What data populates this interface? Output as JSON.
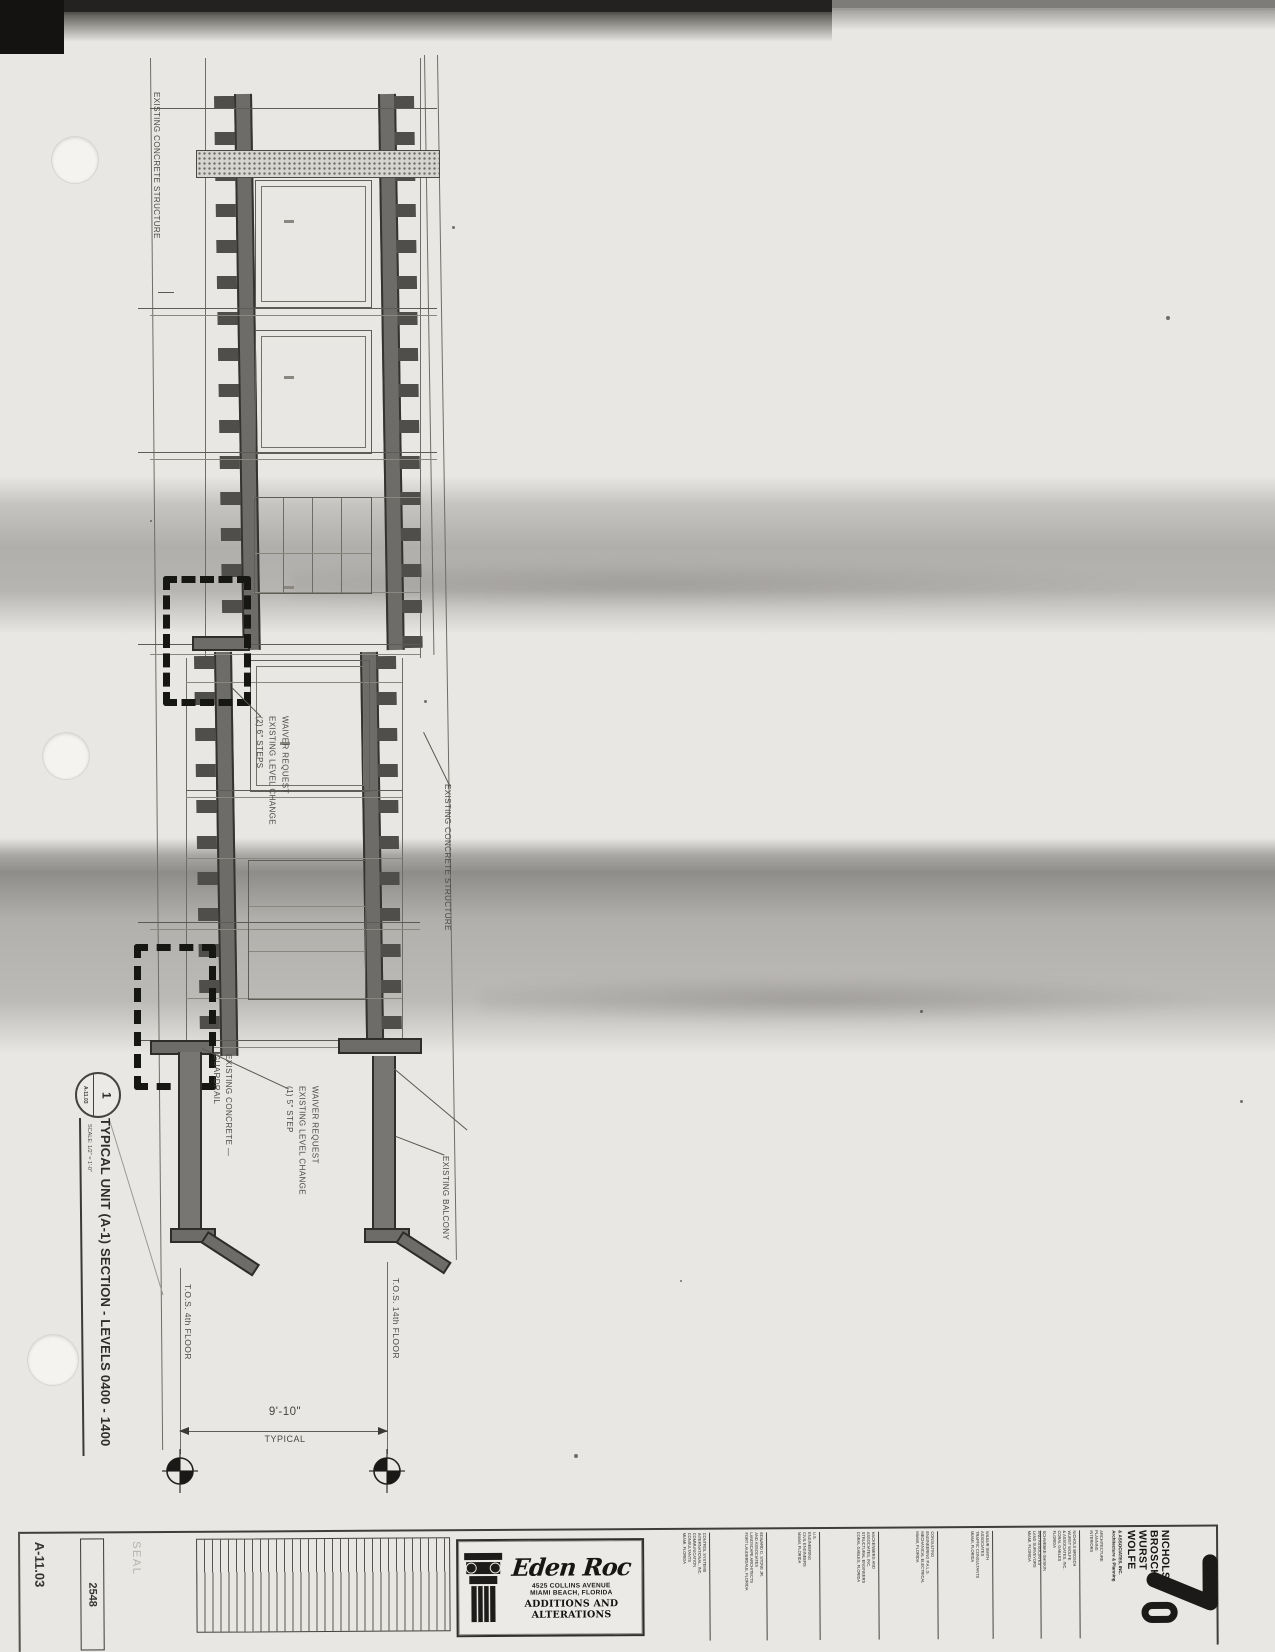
{
  "drawing": {
    "labels": {
      "structure_top": "EXISTING CONCRETE STRUCTURE",
      "structure_mid": "EXISTING CONCRETE STRUCTURE",
      "waiver_upper": "WAIVER REQUEST\nEXISTING LEVEL CHANGE\n(2) 6\" STEPS",
      "waiver_lower": "WAIVER REQUEST\nEXISTING LEVEL CHANGE\n(1) 5\" STEP",
      "guardrail": "EXISTING CONCRETE —\nGUARDRAIL",
      "balcony": "EXISTING BALCONY",
      "tos_4th": "T.O.S. 4th FLOOR",
      "tos_14th": "T.O.S. 14th FLOOR",
      "dim_value": "9'-10\"",
      "dim_note": "TYPICAL"
    },
    "title": {
      "bubble_number": "1",
      "bubble_sheet": "A-11.03",
      "text": "TYPICAL UNIT (A-1) SECTION - LEVELS 0400 - 1400",
      "scale": "SCALE: 1/2\" = 1'-0\""
    }
  },
  "titleblock": {
    "sheet_number": "A-11.03",
    "project_number": "2548",
    "seal_label": "SEAL",
    "project": {
      "name": "Eden Roc",
      "address_line1": "4525 COLLINS AVENUE",
      "address_line2": "MIAMI BEACH, FLORIDA",
      "subtitle": "ADDITIONS AND ALTERATIONS"
    },
    "consultants": [
      "CONTROL SYSTEMS\nINTERNATIONAL, INC.\nCOMMUNICATION\nCONSULTANTS\nMIAMI, FLORIDA",
      "EDWARD D. STONE JR.\nAND ASSOCIATES\nLANDSCAPE ARCHITECTS\nFORT LAUDERDALE, FLORIDA",
      "U.S.\nENGINEERING\nCIVIL ENGINEERS\nMIAMI, FLORIDA",
      "HACKENBERG AND\nASSOCIATES, INC.\nSTRUCTURAL ENGINEERS\nCORAL GABLES, FLORIDA",
      "CONSULTING\nENGINEERING P.A.L.S.\nMECHANICAL ELECTRICAL\nMIAMI, FLORIDA",
      "WILBUR SMITH\nASSOCIATES\nTRAFFIC CONSULTANTS\nMIAMI, FLORIDA",
      "SCHWEBKE-SHISKIN\nAND ASSOCIATES\nLAND SURVEYORS\nMIAMI, FLORIDA"
    ],
    "architect": {
      "micro_col1": "NICHOLS BROSCH\nWURST WOLFE\n& ASSOCIATES, INC.\nCORAL GABLES\nFLORIDA",
      "micro_col2": "ARCHITECTURE\nPLANNING\nINTERIORS",
      "name_stack": "NICHOLS\nBROSCH\nWURST\nWOLFE",
      "suffix": "& ASSOCIATES, INC.\nArchitecture & Planning",
      "logo": "70"
    }
  }
}
